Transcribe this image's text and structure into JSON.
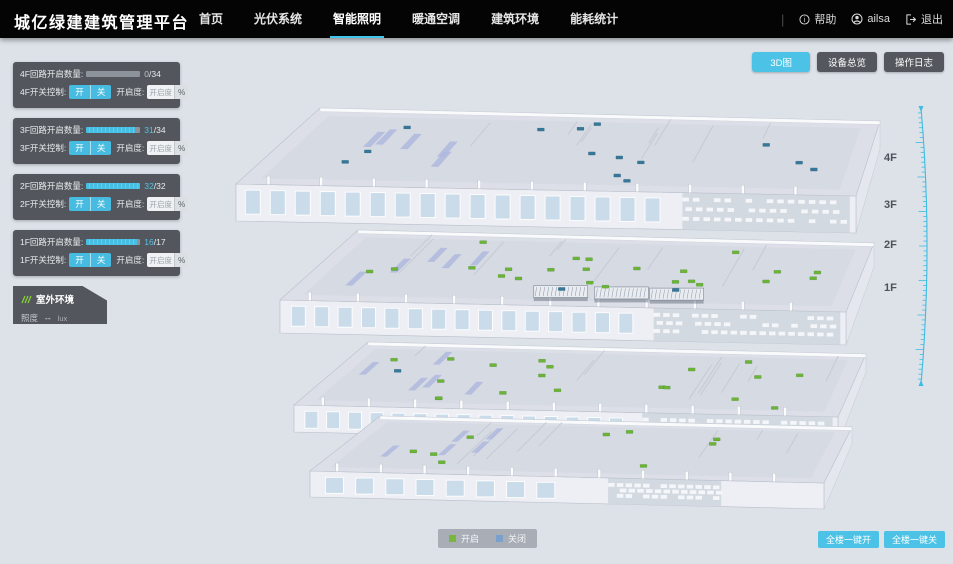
{
  "navbar": {
    "brand": "城亿绿建建筑管理平台",
    "menu": [
      {
        "label": "首页",
        "active": false
      },
      {
        "label": "光伏系统",
        "active": false
      },
      {
        "label": "智能照明",
        "active": true
      },
      {
        "label": "暖通空调",
        "active": false
      },
      {
        "label": "建筑环境",
        "active": false
      },
      {
        "label": "能耗统计",
        "active": false
      }
    ],
    "help": "帮助",
    "user": "ailsa",
    "logout": "退出"
  },
  "view_buttons": [
    {
      "label": "3D图",
      "active": true
    },
    {
      "label": "设备总览",
      "active": false
    },
    {
      "label": "操作日志",
      "active": false
    }
  ],
  "floor_panels": [
    {
      "circuit_label": "4F回路开启数量:",
      "open_text": "0",
      "total_text": "/34",
      "progress_pct": 0,
      "count_color": "#b9c2c8",
      "switch_label": "4F开关控制:",
      "on_label": "开",
      "off_label": "关",
      "dim_label": "开启度:",
      "dim_placeholder": "开启度",
      "percent": "%"
    },
    {
      "circuit_label": "3F回路开启数量:",
      "open_text": "31",
      "total_text": "/34",
      "progress_pct": 91,
      "count_color": "#4fc3e6",
      "switch_label": "3F开关控制:",
      "on_label": "开",
      "off_label": "关",
      "dim_label": "开启度:",
      "dim_placeholder": "开启度",
      "percent": "%"
    },
    {
      "circuit_label": "2F回路开启数量:",
      "open_text": "32",
      "total_text": "/32",
      "progress_pct": 100,
      "count_color": "#4fc3e6",
      "switch_label": "2F开关控制:",
      "on_label": "开",
      "off_label": "关",
      "dim_label": "开启度:",
      "dim_placeholder": "开启度",
      "percent": "%"
    },
    {
      "circuit_label": "1F回路开启数量:",
      "open_text": "16",
      "total_text": "/17",
      "progress_pct": 94,
      "count_color": "#4fc3e6",
      "switch_label": "1F开关控制:",
      "on_label": "开",
      "off_label": "关",
      "dim_label": "开启度:",
      "dim_placeholder": "开启度",
      "percent": "%"
    }
  ],
  "outdoor": {
    "title": "室外环境",
    "metric": "照度",
    "value": "--",
    "unit": "lux"
  },
  "floor_labels": [
    "4F",
    "3F",
    "2F",
    "1F"
  ],
  "legend": [
    {
      "label": "开启",
      "color": "#78b63f"
    },
    {
      "label": "关闭",
      "color": "#7aa0cc"
    }
  ],
  "bulk_buttons": {
    "all_on": "全楼一键开",
    "all_off": "全楼一键关"
  },
  "building": {
    "floors": [
      {
        "name": "4F",
        "green_lights": 0,
        "blue_lights": 14
      },
      {
        "name": "3F",
        "green_lights": 23,
        "blue_lights": 2
      },
      {
        "name": "2F",
        "green_lights": 19,
        "blue_lights": 1
      },
      {
        "name": "1F",
        "green_lights": 9,
        "blue_lights": 0
      }
    ],
    "on_color": "#6ab437",
    "off_color": "#36789a"
  },
  "colors": {
    "accent": "#4cc3e6",
    "header_bg": "#040404",
    "panel_bg": "#44484e",
    "page_bg": "#dde2e9"
  }
}
